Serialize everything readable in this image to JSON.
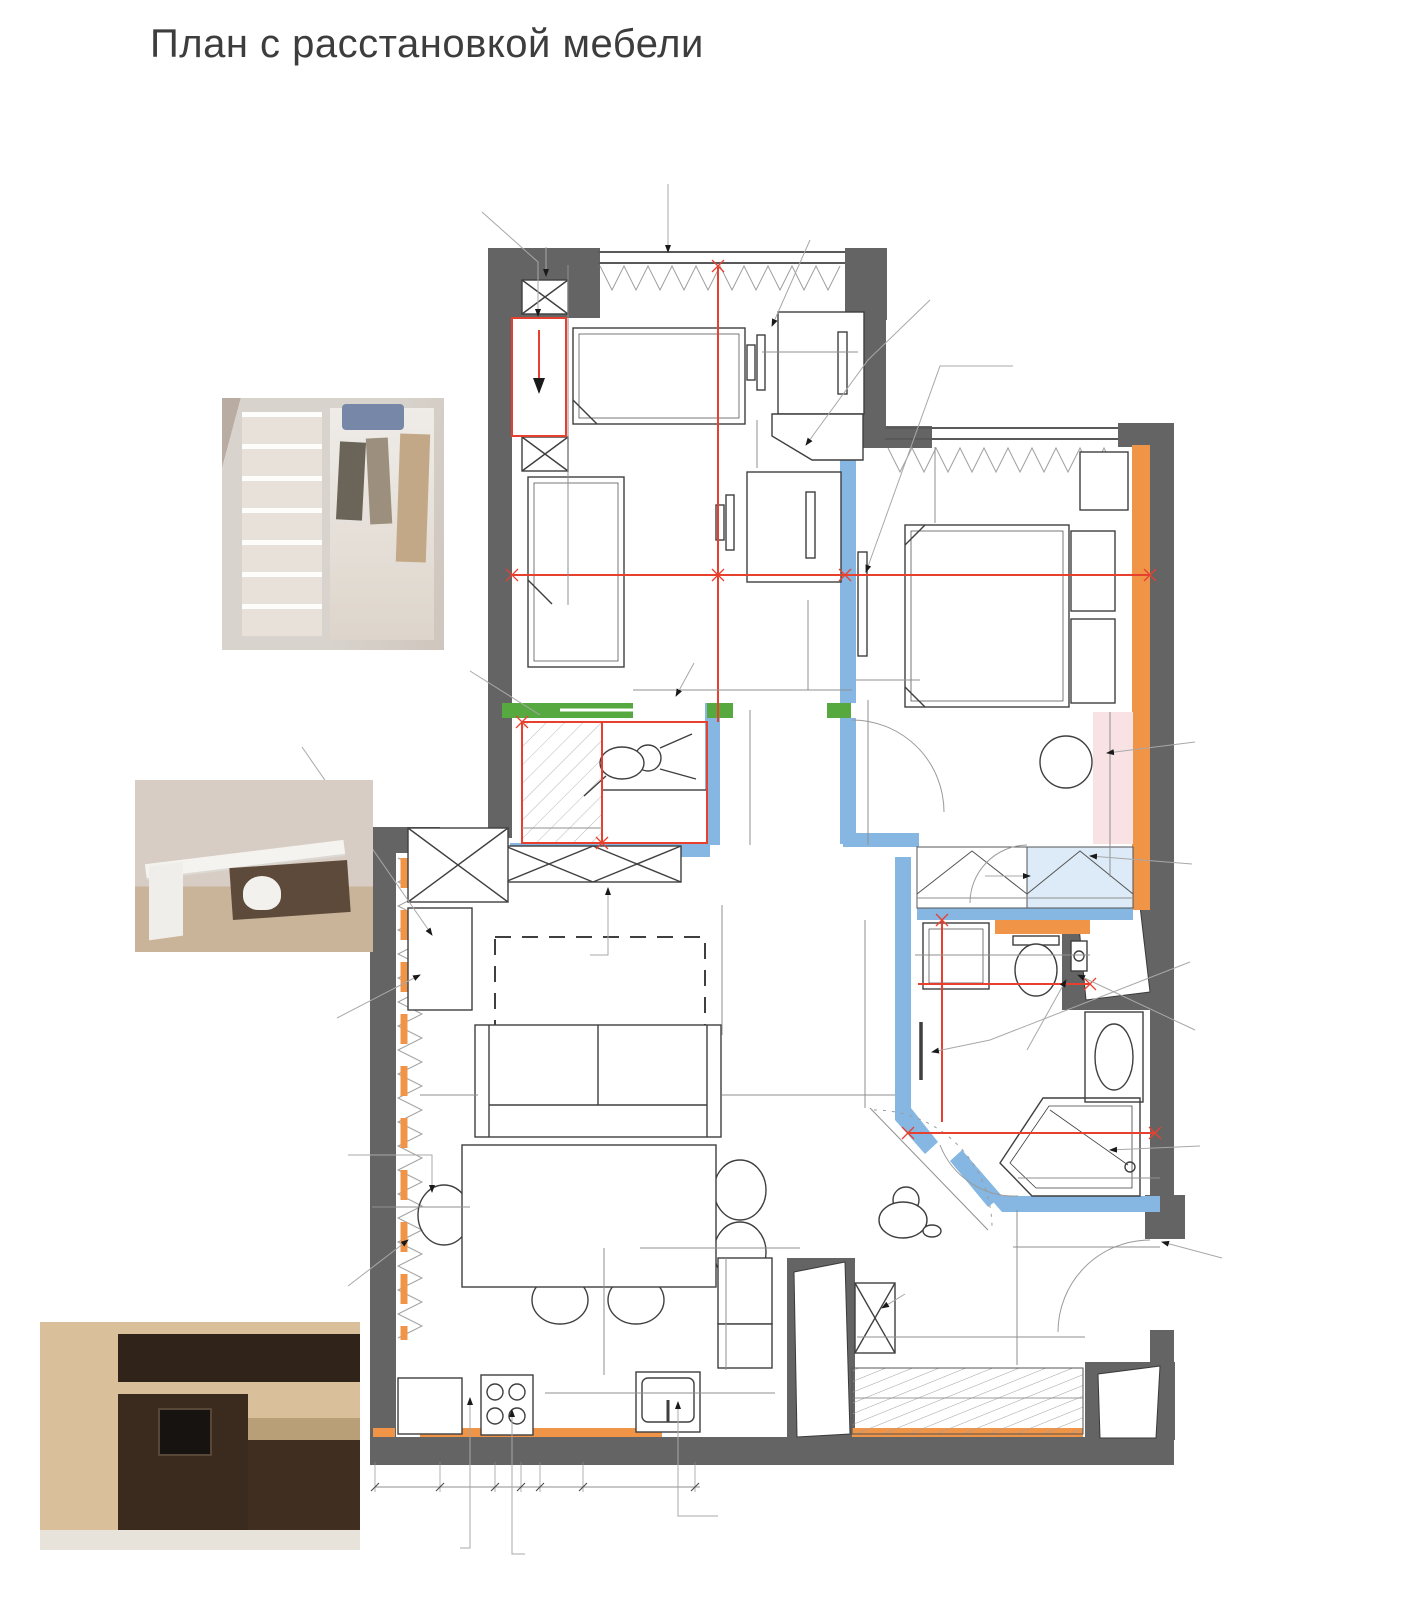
{
  "title": "План с расстановкой мебели",
  "colors": {
    "wall": "#646464",
    "accent_orange": "#f09448",
    "partition_blue": "#85b7e2",
    "door_green": "#55a93f",
    "dim_red": "#e8402f",
    "area_blue": "#3a57a7",
    "closet_fill": "#dcebf7",
    "dressing_fill": "#f9e2e4"
  },
  "plan": {
    "areas_m2": [
      "13,23",
      "10,64",
      "23,63",
      "4,49",
      "5,97"
    ],
    "labels": [
      {
        "t": "3 850",
        "x": 708,
        "y": 490,
        "r": -90,
        "c": "red"
      },
      {
        "t": "2 880",
        "x": 668,
        "y": 563,
        "c": "red"
      },
      {
        "t": "100",
        "x": 824,
        "y": 563,
        "c": "red"
      },
      {
        "t": "2 600",
        "x": 960,
        "y": 563,
        "c": "red"
      },
      {
        "t": "150",
        "x": 1090,
        "y": 563,
        "c": "red"
      },
      {
        "t": "1679",
        "x": 592,
        "y": 711,
        "c": "red"
      },
      {
        "t": "1 100",
        "x": 588,
        "y": 778,
        "r": -90,
        "c": "red"
      },
      {
        "t": "1 550",
        "x": 1000,
        "y": 973,
        "c": "red"
      },
      {
        "t": "1 748",
        "x": 929,
        "y": 1020,
        "r": -90,
        "c": "red"
      },
      {
        "t": "2 050",
        "x": 1022,
        "y": 1121,
        "c": "red"
      },
      {
        "t": "13,23",
        "x": 658,
        "y": 503,
        "c": "area"
      },
      {
        "t": "10,64",
        "x": 1000,
        "y": 692,
        "c": "area"
      },
      {
        "t": "23,63",
        "x": 655,
        "y": 1013,
        "c": "area"
      },
      {
        "t": "4,49",
        "x": 991,
        "y": 1097,
        "c": "area"
      },
      {
        "t": "5,97",
        "x": 1078,
        "y": 1269,
        "c": "area"
      },
      {
        "t": "ПМ",
        "x": 617,
        "y": 1416,
        "c": "blue"
      },
      {
        "t": "МС",
        "x": 953,
        "y": 957,
        "r": -90,
        "c": "blue"
      },
      {
        "t": "X",
        "x": 428,
        "y": 1398,
        "c": "blue"
      },
      {
        "t": "300",
        "x": 556,
        "y": 296,
        "r": -90
      },
      {
        "t": "1 100",
        "x": 558,
        "y": 372,
        "r": -90
      },
      {
        "t": "300",
        "x": 556,
        "y": 556,
        "r": -90
      },
      {
        "t": "490",
        "x": 812,
        "y": 350
      },
      {
        "t": "1200 x 600",
        "x": 818,
        "y": 388
      },
      {
        "t": "350",
        "x": 752,
        "y": 434,
        "r": -90
      },
      {
        "t": "1200 x 600",
        "x": 806,
        "y": 557
      },
      {
        "t": "700",
        "x": 941,
        "y": 486,
        "r": -90
      },
      {
        "t": "1750 x 2100",
        "x": 1000,
        "y": 612
      },
      {
        "t": "матрас 1600 x 2000",
        "x": 1000,
        "y": 631
      },
      {
        "t": "500",
        "x": 877,
        "y": 667
      },
      {
        "t": "700",
        "x": 670,
        "y": 676
      },
      {
        "t": "900",
        "x": 781,
        "y": 670
      },
      {
        "t": "1 100",
        "x": 803,
        "y": 640,
        "r": -90
      },
      {
        "t": "900",
        "x": 872,
        "y": 778,
        "r": -90
      },
      {
        "t": "1 200",
        "x": 744,
        "y": 777,
        "r": -90
      },
      {
        "t": "600",
        "x": 558,
        "y": 814
      },
      {
        "t": "полки",
        "x": 655,
        "y": 816
      },
      {
        "t": "400",
        "x": 691,
        "y": 816,
        "r": -90
      },
      {
        "t": "вешалки",
        "x": 554,
        "y": 757,
        "r": -90
      },
      {
        "t": "1600 x 400",
        "x": 604,
        "y": 884
      },
      {
        "t": "600",
        "x": 874,
        "y": 870
      },
      {
        "t": "2 293",
        "x": 857,
        "y": 977,
        "r": -90
      },
      {
        "t": "1 000",
        "x": 971,
        "y": 888
      },
      {
        "t": "1 000",
        "x": 1080,
        "y": 888
      },
      {
        "t": "700",
        "x": 950,
        "y": 944
      },
      {
        "t": "850",
        "x": 1040,
        "y": 944
      },
      {
        "t": "800 x 500",
        "x": 1111,
        "y": 1056,
        "r": -90
      },
      {
        "t": "1 230",
        "x": 1111,
        "y": 769,
        "r": -90
      },
      {
        "t": "400",
        "x": 1112,
        "y": 857
      },
      {
        "t": "900",
        "x": 1060,
        "y": 1149,
        "r": -90
      },
      {
        "t": "1 100",
        "x": 1080,
        "y": 1170
      },
      {
        "t": "800",
        "x": 949,
        "y": 1161,
        "r": 45
      },
      {
        "t": "1 124",
        "x": 900,
        "y": 1193,
        "r": 45
      },
      {
        "t": "1 400",
        "x": 1076,
        "y": 1235
      },
      {
        "t": "1 330",
        "x": 1016,
        "y": 1279,
        "r": -90
      },
      {
        "t": "2 100",
        "x": 967,
        "y": 1329
      },
      {
        "t": "1 700",
        "x": 713,
        "y": 942,
        "r": -90
      },
      {
        "t": "730",
        "x": 440,
        "y": 1086
      },
      {
        "t": "2200 x 1100",
        "x": 596,
        "y": 1080
      },
      {
        "t": "1 100",
        "x": 780,
        "y": 1080
      },
      {
        "t": "650",
        "x": 447,
        "y": 1195
      },
      {
        "t": "150",
        "x": 384,
        "y": 1195
      },
      {
        "t": "1400 x 800",
        "x": 563,
        "y": 1202
      },
      {
        "t": "850",
        "x": 685,
        "y": 1236
      },
      {
        "t": "450",
        "x": 757,
        "y": 1236
      },
      {
        "t": "1 142",
        "x": 601,
        "y": 1302,
        "r": -90
      },
      {
        "t": "600",
        "x": 709,
        "y": 1290,
        "r": -90
      },
      {
        "t": "379",
        "x": 710,
        "y": 1342,
        "r": -90
      },
      {
        "t": "900",
        "x": 648,
        "y": 1383
      },
      {
        "t": "раб зона",
        "x": 647,
        "y": 1400
      },
      {
        "t": "700",
        "x": 386,
        "y": 1476
      },
      {
        "t": "200",
        "x": 450,
        "y": 1476
      },
      {
        "t": "600",
        "x": 506,
        "y": 1476
      },
      {
        "t": "50",
        "x": 530,
        "y": 1461
      },
      {
        "t": "600",
        "x": 562,
        "y": 1476
      },
      {
        "t": "1 200",
        "x": 640,
        "y": 1476
      },
      {
        "t": "вешалки",
        "x": 377,
        "y": 466,
        "c": "pw"
      },
      {
        "t": "полки",
        "x": 290,
        "y": 501,
        "c": "pw"
      },
      {
        "t": "отзовик",
        "x": 330,
        "y": 946,
        "c": "pm"
      },
      {
        "t": "микроволновка",
        "x": 160,
        "y": 1444,
        "c": "pr"
      },
      {
        "t": "СТИЛЬНЫЕ",
        "x": 322,
        "y": 1530,
        "c": "pm"
      },
      {
        "t": "КУХНИ",
        "x": 318,
        "y": 1540,
        "c": "pm"
      }
    ],
    "callouts": [
      {
        "x": 363,
        "y": 178,
        "lines": [
          "откидная кровать",
          "размер терминала",
          "1100 x 360 мм"
        ]
      },
      {
        "x": 533,
        "y": 222,
        "lines": [
          "стеллаж"
        ]
      },
      {
        "x": 620,
        "y": 156,
        "lines": [
          "шторы рулонки"
        ]
      },
      {
        "x": 733,
        "y": 188,
        "lines": [
          "уроки делать только",
          "при сложенной кровати"
        ]
      },
      {
        "x": 928,
        "y": 283,
        "lines": [
          "скошенная тумба"
        ]
      },
      {
        "x": 1013,
        "y": 318,
        "lines": [
          "ТВ на стене",
          "(надо вешать выше головы,",
          "чтобы не задевать)",
          "лежа смотреть удобно"
        ]
      },
      {
        "x": 213,
        "y": 656,
        "lines": [
          "пример наполнения гардеробной"
        ]
      },
      {
        "x": 135,
        "y": 708,
        "lines": [
          "а можно поставить",
          "тумбу - трансформер",
          "(тумба - стол)"
        ]
      },
      {
        "x": 228,
        "y": 993,
        "lines": [
          "рабочий стол",
          "900 x 500"
        ]
      },
      {
        "x": 190,
        "y": 1128,
        "lines": [
          "сюда сажать самого",
          "маленького"
        ]
      },
      {
        "x": 148,
        "y": 1263,
        "lines": [
          "встроенная микроволновка",
          "высота терминала 1400 мм"
        ]
      },
      {
        "x": 377,
        "y": 1534,
        "lines": [
          "бутылочница"
        ]
      },
      {
        "x": 525,
        "y": 1539,
        "lines": [
          "духовка под плитой"
        ]
      },
      {
        "x": 718,
        "y": 1489,
        "lines": [
          "доступ в угол",
          "со стороны мойки"
        ]
      },
      {
        "x": 1195,
        "y": 704,
        "lines": [
          "узкий",
          "туалетный",
          "столик"
        ]
      },
      {
        "x": 1192,
        "y": 848,
        "lines": [
          "угловой шкаф для одежды"
        ]
      },
      {
        "x": 1190,
        "y": 933,
        "lines": [
          "полотен-ль",
          "электрический"
        ]
      },
      {
        "x": 1195,
        "y": 996,
        "lines": [
          "стир и",
          "суш машина",
          "в колонке"
        ]
      },
      {
        "x": 1200,
        "y": 1108,
        "lines": [
          "душ кабина",
          "в строительном",
          "исполнении"
        ]
      },
      {
        "x": 1222,
        "y": 1234,
        "lines": [
          "полка для",
          "мелочи"
        ]
      },
      {
        "x": 678,
        "y": 634,
        "lines": [
          "дверь-пенал"
        ]
      },
      {
        "x": 448,
        "y": 939,
        "lines": [
          "тумба под ТВ и ТВ"
        ]
      },
      {
        "x": 965,
        "y": 1041,
        "lines": [
          "гиг душ"
        ]
      },
      {
        "x": 905,
        "y": 1278,
        "lines": [
          "пуф"
        ]
      }
    ]
  },
  "photos": {
    "wardrobe": {
      "caption": "пример наполнения гардеробной"
    },
    "desk": {
      "watermark": "отзовик"
    },
    "kitchen": {
      "watermark": "СТИЛЬНЫЕ КУХНИ"
    }
  }
}
